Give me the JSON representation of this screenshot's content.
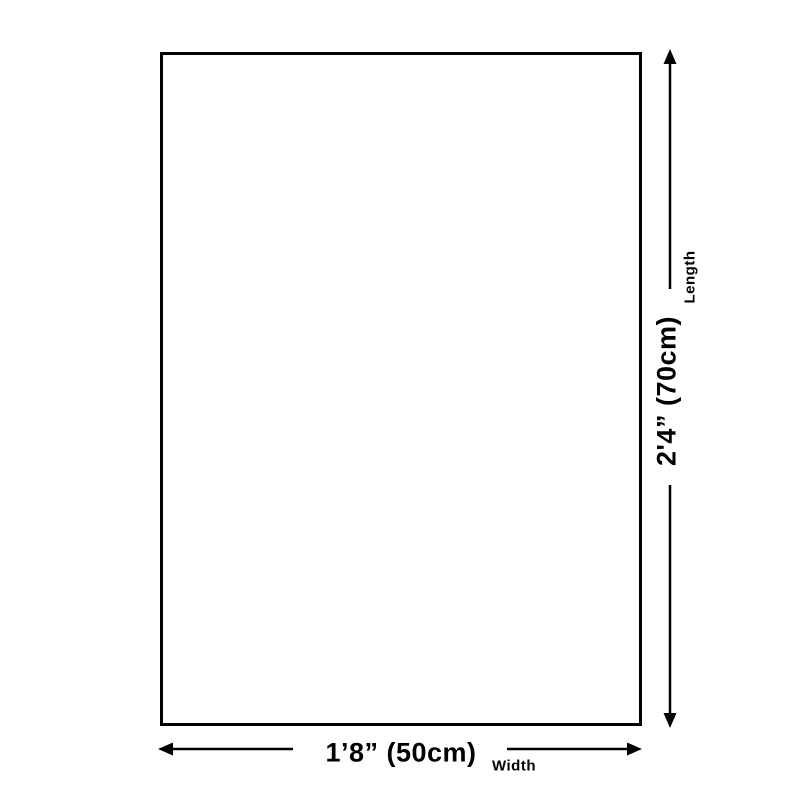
{
  "page": {
    "background_color": "#ffffff",
    "line_color": "#000000"
  },
  "diagram": {
    "product_box": {
      "fill_color": "#ffffff",
      "border_color": "#000000"
    },
    "length": {
      "value": "2'4” (70cm)",
      "label": "Length"
    },
    "width": {
      "value": "1’8” (50cm)",
      "label": "Width"
    }
  }
}
